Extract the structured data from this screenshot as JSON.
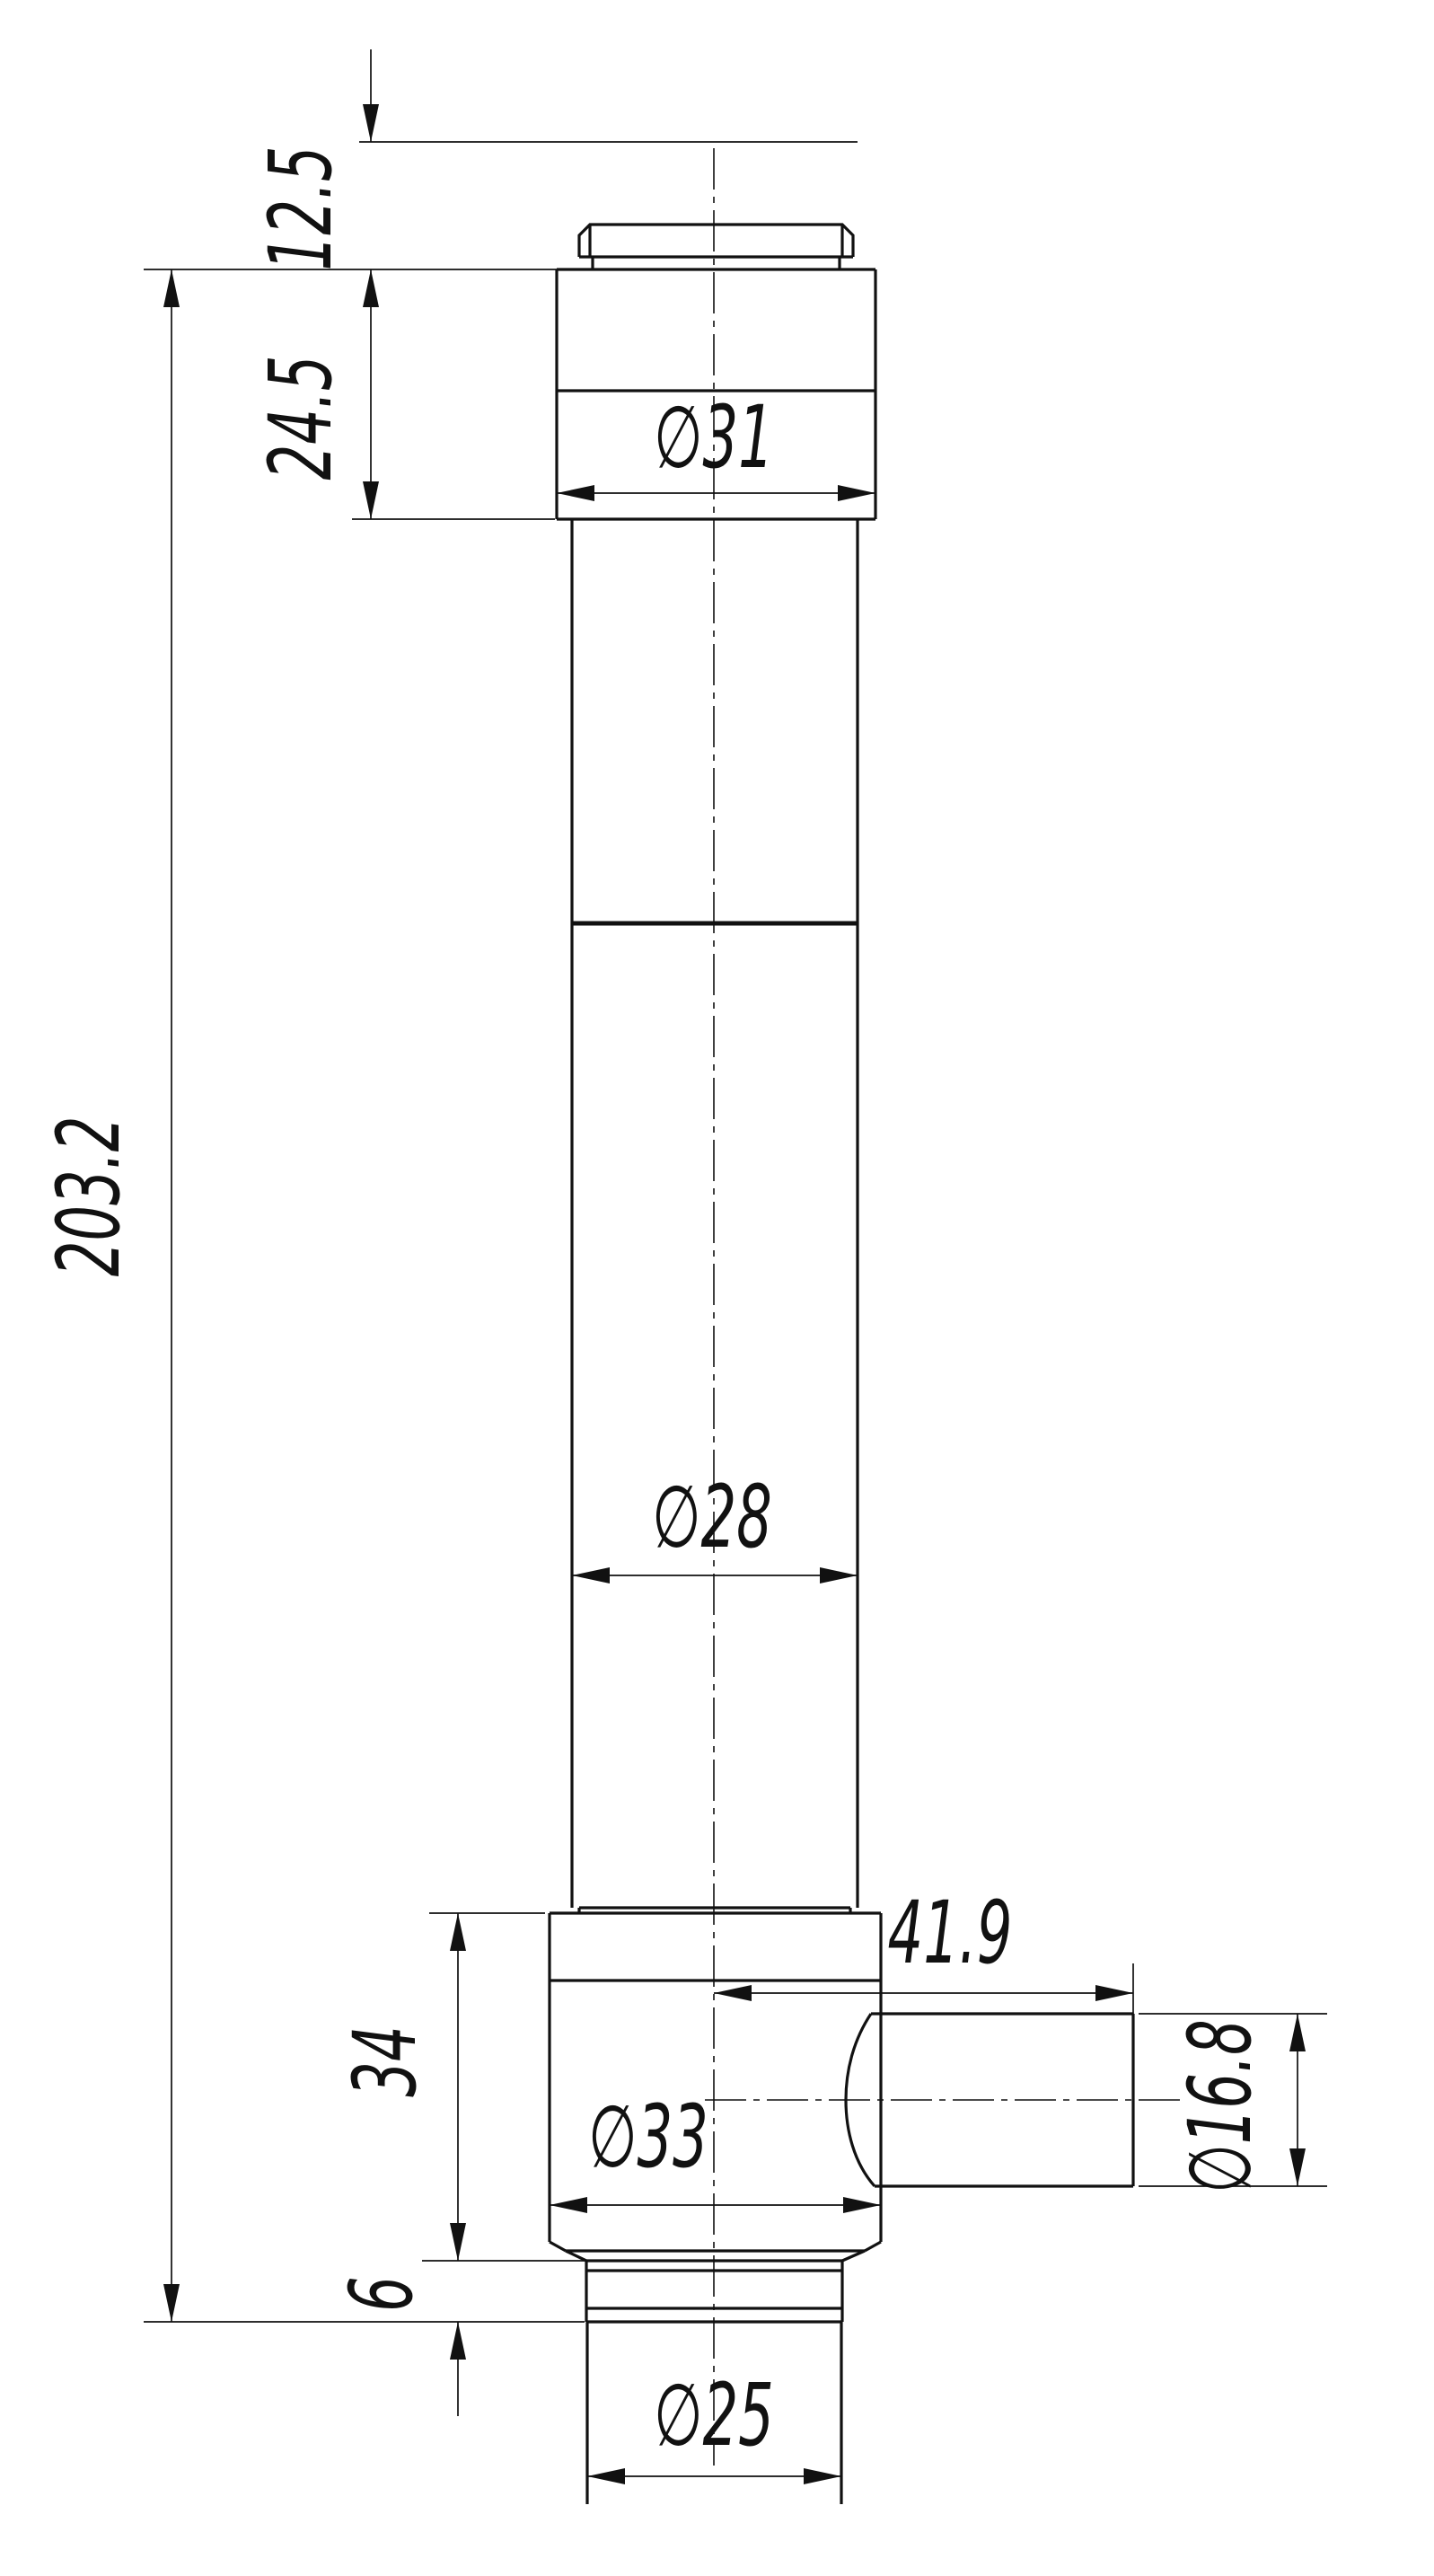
{
  "drawing": {
    "title": "cylindrical-part-dimension-drawing",
    "background_color": "#ffffff",
    "line_color": "#111111",
    "dimensions": {
      "cap_height": "12.5",
      "upper_block_height": "24.5",
      "upper_block_diameter": "∅31",
      "overall_height": "203.2",
      "tube_diameter": "∅28",
      "port_length": "41.9",
      "lower_block_height": "34",
      "lower_block_diameter": "∅33",
      "port_diameter": "∅16.8",
      "flange_height": "6",
      "stub_diameter": "∅25"
    }
  }
}
